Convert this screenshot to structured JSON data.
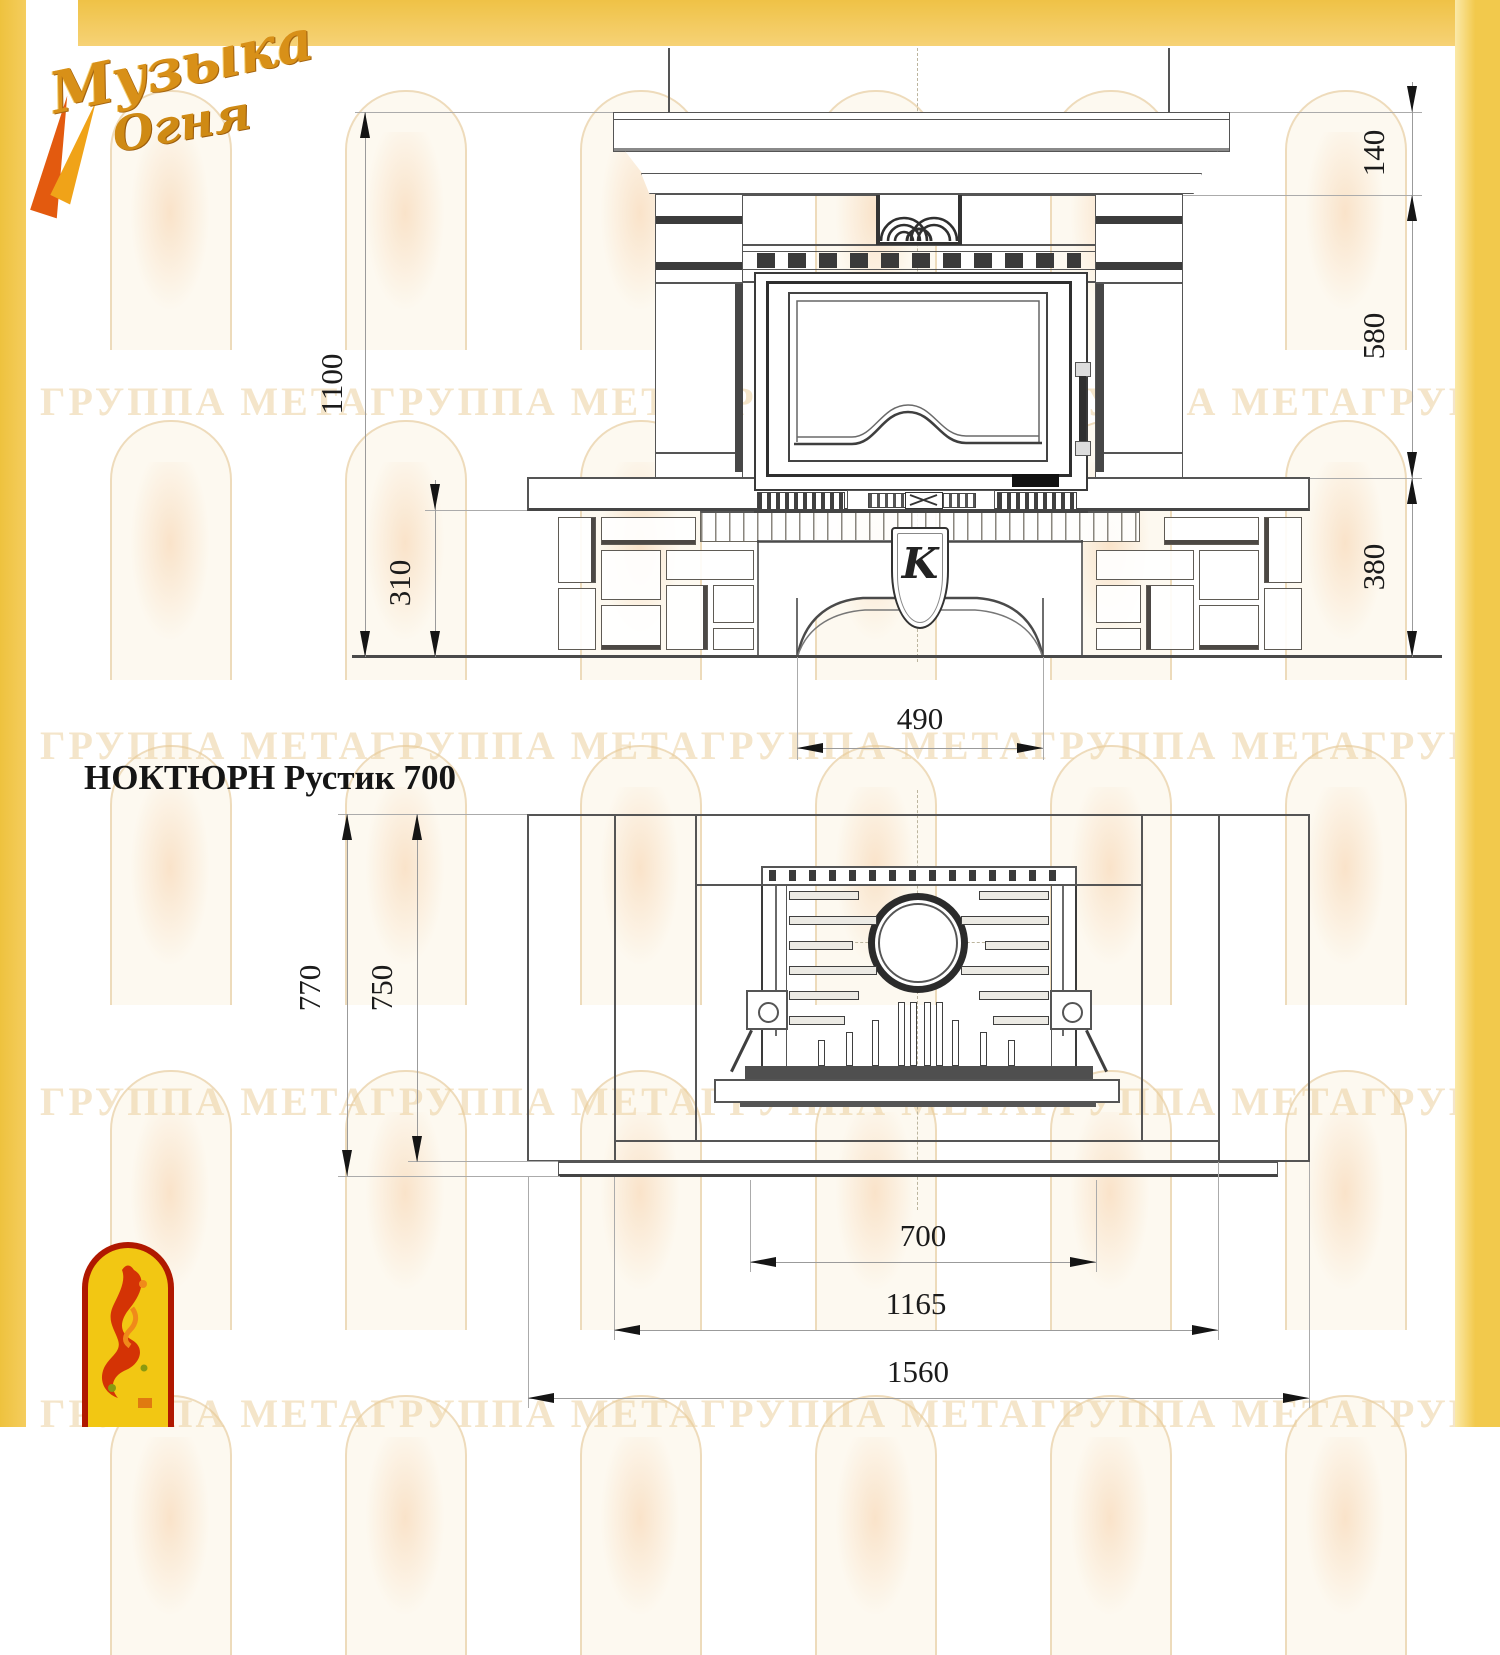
{
  "logo": {
    "word1": "Музыка",
    "word2": "Огня"
  },
  "title": "НОКТЮРН Рустик 700",
  "watermark": {
    "row": "ГРУППА МЕТАГРУППА МЕТАГРУППА МЕТАГРУППА МЕТАГРУППА МЕТА"
  },
  "front_view": {
    "keystone_letter": "K",
    "dims": {
      "total_height": "1100",
      "plinth_height": "310",
      "mantel_height": "140",
      "firebox_zone_height": "580",
      "base_height": "380",
      "opening_width": "490"
    }
  },
  "plan_view": {
    "dims": {
      "total_depth": "770",
      "body_depth": "750",
      "insert_width": "700",
      "body_width": "1165",
      "total_width": "1560"
    }
  },
  "colors": {
    "accent_yellow": "#f2c94c",
    "logo_red": "#b01800",
    "line_gray": "#555555"
  }
}
